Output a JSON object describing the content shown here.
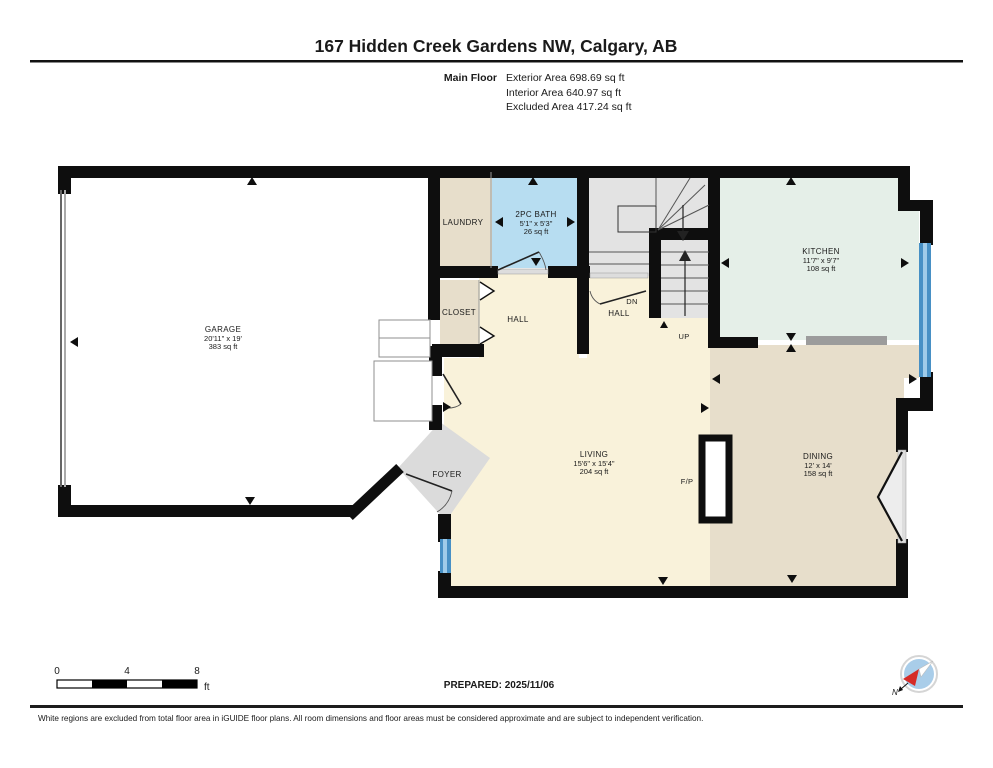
{
  "header": {
    "title": "167 Hidden Creek Gardens NW, Calgary, AB",
    "floor_label": "Main Floor",
    "area_lines": [
      "Exterior Area 698.69 sq ft",
      "Interior Area 640.97 sq ft",
      "Excluded Area 417.24 sq ft"
    ]
  },
  "rooms": {
    "garage": {
      "name": "GARAGE",
      "dims": "20'11\" x 19'",
      "area": "383 sq ft"
    },
    "laundry": {
      "name": "LAUNDRY"
    },
    "bath": {
      "name": "2PC BATH",
      "dims": "5'1\" x 5'3\"",
      "area": "26 sq ft"
    },
    "closet": {
      "name": "CLOSET"
    },
    "hall_left": {
      "name": "HALL"
    },
    "hall_right": {
      "name": "HALL"
    },
    "kitchen": {
      "name": "KITCHEN",
      "dims": "11'7\" x 9'7\"",
      "area": "108 sq ft"
    },
    "living": {
      "name": "LIVING",
      "dims": "15'6\" x 15'4\"",
      "area": "204 sq ft"
    },
    "dining": {
      "name": "DINING",
      "dims": "12' x 14'",
      "area": "158 sq ft"
    },
    "foyer": {
      "name": "FOYER"
    },
    "fireplace": {
      "name": "F/P"
    }
  },
  "stairs": {
    "dn": "DN",
    "up": "UP"
  },
  "scale_bar": {
    "tick0": "0",
    "tick4": "4",
    "tick8": "8",
    "unit": "ft"
  },
  "footer": {
    "prepared": "PREPARED: 2025/11/06",
    "compass_north": "N",
    "disclaimer": "White regions are excluded from total floor area in iGUIDE floor plans. All room dimensions and floor areas must be considered approximate and are subject to independent verification."
  },
  "colors": {
    "wall": "#0e0e0e",
    "living": "#f9f2da",
    "dining": "#e7decb",
    "kitchen": "#e5efe8",
    "bath": "#b7ddf1",
    "stairs": "#e3e3e3",
    "foyer": "#dbdbdb",
    "window": "#4790c5",
    "window_light": "#9fcbe9",
    "counter": "#9c9c9c"
  }
}
